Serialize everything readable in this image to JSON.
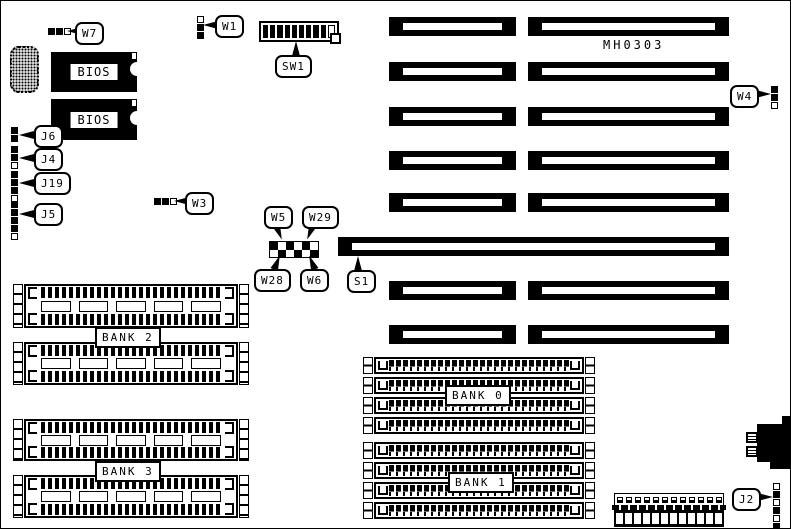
{
  "board": {
    "model": "MH0303",
    "colors": {
      "ink": "#000000",
      "paper": "#ffffff"
    },
    "chips": {
      "bios1": "BIOS",
      "bios2": "BIOS"
    },
    "banks": {
      "bank0": "BANK 0",
      "bank1": "BANK 1",
      "bank2": "BANK 2",
      "bank3": "BANK 3"
    },
    "callouts": {
      "w7": "W7",
      "w1": "W1",
      "sw1": "SW1",
      "w3": "W3",
      "w4": "W4",
      "w5": "W5",
      "w29": "W29",
      "w28": "W28",
      "w6": "W6",
      "s1": "S1",
      "j6": "J6",
      "j4": "J4",
      "j19": "J19",
      "j5": "J5",
      "j2": "J2"
    }
  }
}
